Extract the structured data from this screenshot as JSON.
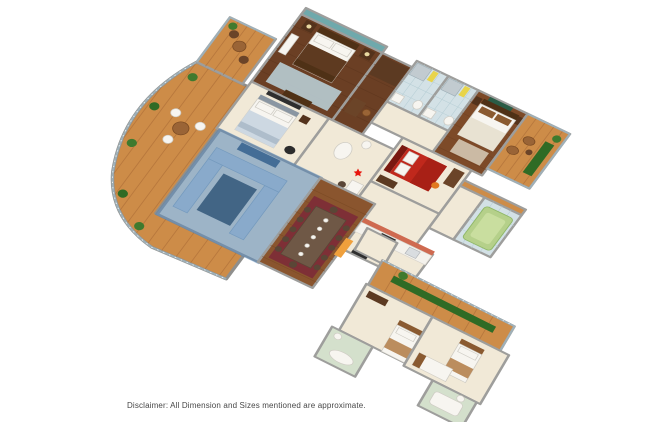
{
  "scene": {
    "type": "3d-isometric-floor-plan",
    "background": "#ffffff",
    "highlight": {
      "room": "living-room",
      "note": "living room shown with translucent blue selection overlay"
    }
  },
  "disclaimer": {
    "text": "Disclaimer: All Dimension and Sizes mentioned are approximate."
  },
  "colors": {
    "teal_accent": "#6fa9ac",
    "highlight": "#4a80b8",
    "red_bed": "#c0281c",
    "red_bed_dark": "#a82016",
    "tub_green": "#b5d08a",
    "orange_accent": "#f0a03c",
    "marker_red": "#e8150d",
    "deck_wood": "#cd8c48",
    "dark_wood": "#6b3f24",
    "cream_floor": "#f1e9d7",
    "bath_tile": "#d3e1e6",
    "counter_tile": "#cf6a50"
  },
  "rooms": [
    {
      "id": "master-bedroom"
    },
    {
      "id": "dressing-area"
    },
    {
      "id": "bathroom-1"
    },
    {
      "id": "bathroom-2"
    },
    {
      "id": "bedroom-2"
    },
    {
      "id": "bedroom-3"
    },
    {
      "id": "kids-bedroom-red"
    },
    {
      "id": "hallway"
    },
    {
      "id": "living-room",
      "highlighted": true
    },
    {
      "id": "dining-area"
    },
    {
      "id": "kitchen"
    },
    {
      "id": "balcony-top-left"
    },
    {
      "id": "left-terrace-curved"
    },
    {
      "id": "balcony-right"
    },
    {
      "id": "bathtub-room-green"
    },
    {
      "id": "lower-wing-balcony"
    },
    {
      "id": "lower-bedroom-1"
    },
    {
      "id": "lower-bedroom-2"
    },
    {
      "id": "lower-bathroom-green"
    },
    {
      "id": "lower-bathroom-2"
    },
    {
      "id": "connector-corridor"
    }
  ]
}
